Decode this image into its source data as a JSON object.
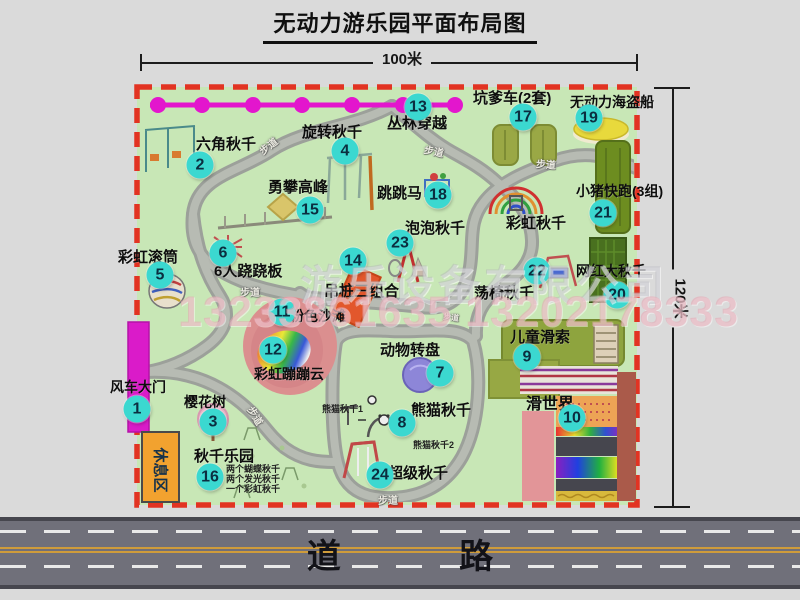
{
  "title": "无动力游乐园平面布局图",
  "dimensions": {
    "width_label": "100米",
    "height_label": "120米"
  },
  "road_label": "道  路",
  "walkway_label": "步道",
  "rest_area_label": "休息区",
  "watermark": {
    "line1": "游乐设备有限公司",
    "line2": "13233861635 13202178333"
  },
  "colors": {
    "park_green": "#c8e7b6",
    "boundary_red": "#e23322",
    "path_gray": "#9ca09a",
    "badge_cyan": "#3bd8d0",
    "zipline_magenta": "#e316cd",
    "gate_magenta": "#da1bc9",
    "rest_area_orange": "#f2a22f",
    "road_gray": "#70707a"
  },
  "attractions": [
    {
      "num": "1",
      "label": "风车大门"
    },
    {
      "num": "2",
      "label": "六角秋千"
    },
    {
      "num": "3",
      "label": "樱花树"
    },
    {
      "num": "4",
      "label": "旋转秋千"
    },
    {
      "num": "5",
      "label": "彩虹滚筒"
    },
    {
      "num": "6",
      "label": "6人跷跷板"
    },
    {
      "num": "7",
      "label": "动物转盘"
    },
    {
      "num": "8",
      "label": "熊猫秋千",
      "sublabels": [
        "熊猫秋千1",
        "熊猫秋千2"
      ]
    },
    {
      "num": "9",
      "label": "儿童滑索"
    },
    {
      "num": "10",
      "label": "滑世界"
    },
    {
      "num": "11",
      "label": "粉色沙滩"
    },
    {
      "num": "12",
      "label": "彩虹蹦蹦云"
    },
    {
      "num": "13",
      "label": "丛林穿越"
    },
    {
      "num": "14",
      "label": "吊桩三组合"
    },
    {
      "num": "15",
      "label": "勇攀高峰"
    },
    {
      "num": "16",
      "label": "秋千乐园",
      "sublabels": [
        "两个蝴蝶秋千",
        "两个发光秋千",
        "一个彩虹秋千"
      ]
    },
    {
      "num": "17",
      "label": "坑爹车(2套)"
    },
    {
      "num": "18",
      "label": "跳跳马"
    },
    {
      "num": "19",
      "label": "无动力海盗船"
    },
    {
      "num": "20",
      "label": "网红大秋千"
    },
    {
      "num": "21",
      "label": "小猪快跑(3组)"
    },
    {
      "num": "22",
      "label": "荡椅秋千"
    },
    {
      "num": "23",
      "label": "泡泡秋千"
    },
    {
      "num": "24",
      "label": "超级秋千"
    },
    {
      "num": "",
      "label": "彩虹秋千"
    }
  ]
}
